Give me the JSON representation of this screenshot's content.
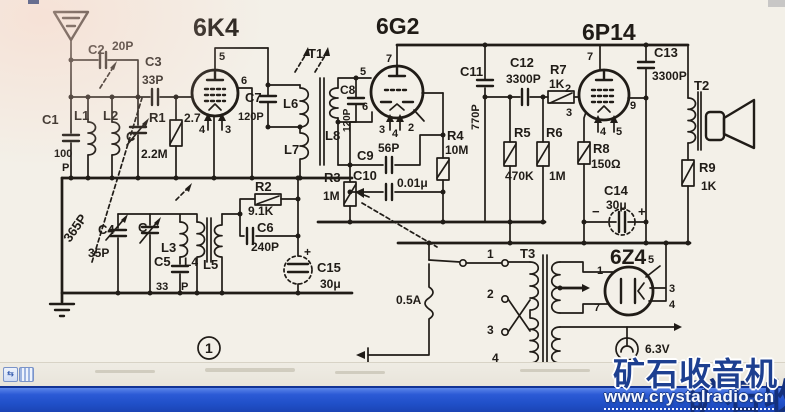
{
  "colors": {
    "paper": "#f3f0e8",
    "ink": "#201c17",
    "taskbar_blue": "#2050c8",
    "watermark_blue": "#1d3f90"
  },
  "watermark": {
    "line1": "矿石收音机",
    "line2": "www.crystalradio.cn"
  },
  "ui": {
    "nav_icon_glyph": "⇆"
  },
  "schematic": {
    "labels": [
      {
        "id": "title-6k4",
        "t": "6K4",
        "x": 193,
        "y": 36,
        "s": 25
      },
      {
        "id": "title-6g2",
        "t": "6G2",
        "x": 376,
        "y": 34,
        "s": 23
      },
      {
        "id": "title-6p14",
        "t": "6P14",
        "x": 582,
        "y": 40,
        "s": 23
      },
      {
        "id": "title-6z4",
        "t": "6Z4",
        "x": 610,
        "y": 264,
        "s": 21
      },
      {
        "id": "c1",
        "t": "C1",
        "x": 42,
        "y": 124,
        "s": 13
      },
      {
        "id": "c1-val",
        "t": "100",
        "x": 54,
        "y": 157,
        "s": 11
      },
      {
        "id": "c1-unit",
        "t": "P",
        "x": 62,
        "y": 171,
        "s": 11
      },
      {
        "id": "c2",
        "t": "C2",
        "x": 88,
        "y": 54,
        "s": 13
      },
      {
        "id": "c2-val",
        "t": "20P",
        "x": 112,
        "y": 50,
        "s": 12
      },
      {
        "id": "c3",
        "t": "C3",
        "x": 145,
        "y": 66,
        "s": 13
      },
      {
        "id": "c3-val",
        "t": "33P",
        "x": 142,
        "y": 84,
        "s": 12
      },
      {
        "id": "c4",
        "t": "C4",
        "x": 98,
        "y": 234,
        "s": 13
      },
      {
        "id": "c4-val",
        "t": "35P",
        "x": 88,
        "y": 257,
        "s": 12
      },
      {
        "id": "c-gang1",
        "t": "C",
        "x": 126,
        "y": 141,
        "s": 13
      },
      {
        "id": "c-gang2",
        "t": "C",
        "x": 138,
        "y": 232,
        "s": 13
      },
      {
        "id": "gang-val",
        "t": "365P",
        "x": 70,
        "y": 243,
        "s": 13,
        "r": -55
      },
      {
        "id": "c5",
        "t": "C5",
        "x": 154,
        "y": 266,
        "s": 13
      },
      {
        "id": "c5-val",
        "t": "33",
        "x": 156,
        "y": 290,
        "s": 11
      },
      {
        "id": "c5-unit",
        "t": "P",
        "x": 181,
        "y": 290,
        "s": 11
      },
      {
        "id": "c6",
        "t": "C6",
        "x": 257,
        "y": 232,
        "s": 13
      },
      {
        "id": "c6-val",
        "t": "240P",
        "x": 251,
        "y": 251,
        "s": 12
      },
      {
        "id": "c7",
        "t": "C7",
        "x": 245,
        "y": 102,
        "s": 13
      },
      {
        "id": "c7-val",
        "t": "120P",
        "x": 238,
        "y": 120,
        "s": 11
      },
      {
        "id": "c8",
        "t": "C8",
        "x": 340,
        "y": 94,
        "s": 12
      },
      {
        "id": "c8-val",
        "t": "120P",
        "x": 350,
        "y": 132,
        "s": 10,
        "r": -90
      },
      {
        "id": "c9",
        "t": "C9",
        "x": 357,
        "y": 160,
        "s": 13
      },
      {
        "id": "c9-val",
        "t": "56P",
        "x": 378,
        "y": 152,
        "s": 12
      },
      {
        "id": "c10",
        "t": "C10",
        "x": 353,
        "y": 180,
        "s": 13
      },
      {
        "id": "c10-val",
        "t": "0.01μ",
        "x": 397,
        "y": 187,
        "s": 12
      },
      {
        "id": "c11",
        "t": "C11",
        "x": 460,
        "y": 76,
        "s": 13
      },
      {
        "id": "c11-val",
        "t": "770P",
        "x": 479,
        "y": 130,
        "s": 11,
        "r": -90
      },
      {
        "id": "c12",
        "t": "C12",
        "x": 510,
        "y": 67,
        "s": 13
      },
      {
        "id": "c12-val",
        "t": "3300P",
        "x": 506,
        "y": 83,
        "s": 12
      },
      {
        "id": "c13",
        "t": "C13",
        "x": 654,
        "y": 57,
        "s": 13
      },
      {
        "id": "c13-val",
        "t": "3300P",
        "x": 652,
        "y": 80,
        "s": 12
      },
      {
        "id": "c14",
        "t": "C14",
        "x": 604,
        "y": 195,
        "s": 13
      },
      {
        "id": "c14-val",
        "t": "30μ",
        "x": 606,
        "y": 209,
        "s": 12
      },
      {
        "id": "c14-plus",
        "t": "+",
        "x": 638,
        "y": 216,
        "s": 13
      },
      {
        "id": "c14-minus",
        "t": "−",
        "x": 592,
        "y": 216,
        "s": 13
      },
      {
        "id": "c15",
        "t": "C15",
        "x": 317,
        "y": 272,
        "s": 13
      },
      {
        "id": "c15-val",
        "t": "30μ",
        "x": 320,
        "y": 288,
        "s": 12
      },
      {
        "id": "c15-plus",
        "t": "+",
        "x": 304,
        "y": 256,
        "s": 12
      },
      {
        "id": "r1",
        "t": "R1",
        "x": 149,
        "y": 122,
        "s": 13
      },
      {
        "id": "r1-val",
        "t": "2.2M",
        "x": 141,
        "y": 158,
        "s": 12
      },
      {
        "id": "r1-aux",
        "t": "2.7",
        "x": 184,
        "y": 122,
        "s": 12
      },
      {
        "id": "r2",
        "t": "R2",
        "x": 255,
        "y": 191,
        "s": 13
      },
      {
        "id": "r2-val",
        "t": "9.1K",
        "x": 248,
        "y": 215,
        "s": 12
      },
      {
        "id": "r3",
        "t": "R3",
        "x": 324,
        "y": 182,
        "s": 13
      },
      {
        "id": "r3-val",
        "t": "1M",
        "x": 323,
        "y": 200,
        "s": 12
      },
      {
        "id": "r4",
        "t": "R4",
        "x": 447,
        "y": 140,
        "s": 13
      },
      {
        "id": "r4-val",
        "t": "10M",
        "x": 445,
        "y": 154,
        "s": 12
      },
      {
        "id": "r5",
        "t": "R5",
        "x": 514,
        "y": 137,
        "s": 13
      },
      {
        "id": "r5-val",
        "t": "470K",
        "x": 505,
        "y": 180,
        "s": 12
      },
      {
        "id": "r6",
        "t": "R6",
        "x": 546,
        "y": 137,
        "s": 13
      },
      {
        "id": "r6-val",
        "t": "1M",
        "x": 549,
        "y": 180,
        "s": 12
      },
      {
        "id": "r7",
        "t": "R7",
        "x": 550,
        "y": 74,
        "s": 13
      },
      {
        "id": "r7-val",
        "t": "1K",
        "x": 549,
        "y": 88,
        "s": 12
      },
      {
        "id": "r8",
        "t": "R8",
        "x": 593,
        "y": 153,
        "s": 13
      },
      {
        "id": "r8-val",
        "t": "150Ω",
        "x": 591,
        "y": 168,
        "s": 12
      },
      {
        "id": "r9",
        "t": "R9",
        "x": 699,
        "y": 172,
        "s": 13
      },
      {
        "id": "r9-val",
        "t": "1K",
        "x": 701,
        "y": 190,
        "s": 12
      },
      {
        "id": "l1",
        "t": "L1",
        "x": 74,
        "y": 120,
        "s": 13
      },
      {
        "id": "l2",
        "t": "L2",
        "x": 103,
        "y": 120,
        "s": 13
      },
      {
        "id": "l3",
        "t": "L3",
        "x": 161,
        "y": 252,
        "s": 13
      },
      {
        "id": "l4",
        "t": "L4",
        "x": 184,
        "y": 266,
        "s": 12
      },
      {
        "id": "l5",
        "t": "L5",
        "x": 203,
        "y": 269,
        "s": 13
      },
      {
        "id": "l6",
        "t": "L6",
        "x": 283,
        "y": 108,
        "s": 13
      },
      {
        "id": "l7",
        "t": "L7",
        "x": 284,
        "y": 154,
        "s": 13
      },
      {
        "id": "l8",
        "t": "L8",
        "x": 325,
        "y": 140,
        "s": 13
      },
      {
        "id": "t1",
        "t": "T1",
        "x": 308,
        "y": 58,
        "s": 13
      },
      {
        "id": "t2",
        "t": "T2",
        "x": 694,
        "y": 90,
        "s": 13
      },
      {
        "id": "t3",
        "t": "T3",
        "x": 520,
        "y": 258,
        "s": 13
      },
      {
        "id": "fuse-val",
        "t": "0.5A",
        "x": 396,
        "y": 304,
        "s": 12
      },
      {
        "id": "pilot-val",
        "t": "6.3V",
        "x": 645,
        "y": 353,
        "s": 12
      },
      {
        "id": "pin-6k4-5",
        "t": "5",
        "x": 219,
        "y": 60,
        "s": 11
      },
      {
        "id": "pin-6k4-6",
        "t": "6",
        "x": 241,
        "y": 84,
        "s": 11
      },
      {
        "id": "pin-6k4-4",
        "t": "4",
        "x": 199,
        "y": 133,
        "s": 11
      },
      {
        "id": "pin-6k4-3",
        "t": "3",
        "x": 225,
        "y": 133,
        "s": 11
      },
      {
        "id": "pin-6g2-7",
        "t": "7",
        "x": 386,
        "y": 62,
        "s": 11
      },
      {
        "id": "pin-6g2-5",
        "t": "5",
        "x": 360,
        "y": 75,
        "s": 11
      },
      {
        "id": "pin-6g2-6",
        "t": "6",
        "x": 362,
        "y": 110,
        "s": 11
      },
      {
        "id": "pin-6g2-3",
        "t": "3",
        "x": 379,
        "y": 133,
        "s": 11
      },
      {
        "id": "pin-6g2-4",
        "t": "4",
        "x": 392,
        "y": 137,
        "s": 11
      },
      {
        "id": "pin-6g2-2",
        "t": "2",
        "x": 408,
        "y": 131,
        "s": 11
      },
      {
        "id": "pin-6p14-7",
        "t": "7",
        "x": 587,
        "y": 60,
        "s": 11
      },
      {
        "id": "pin-6p14-2",
        "t": "2",
        "x": 565,
        "y": 92,
        "s": 11
      },
      {
        "id": "pin-6p14-3",
        "t": "3",
        "x": 566,
        "y": 116,
        "s": 11
      },
      {
        "id": "pin-6p14-9",
        "t": "9",
        "x": 630,
        "y": 109,
        "s": 11
      },
      {
        "id": "pin-6p14-4",
        "t": "4",
        "x": 600,
        "y": 135,
        "s": 11
      },
      {
        "id": "pin-6p14-5",
        "t": "5",
        "x": 616,
        "y": 135,
        "s": 11
      },
      {
        "id": "pin-6z4-1",
        "t": "1",
        "x": 597,
        "y": 274,
        "s": 11
      },
      {
        "id": "pin-6z4-7",
        "t": "7",
        "x": 594,
        "y": 311,
        "s": 11
      },
      {
        "id": "pin-6z4-5",
        "t": "5",
        "x": 648,
        "y": 263,
        "s": 11
      },
      {
        "id": "pin-6z4-3",
        "t": "3",
        "x": 669,
        "y": 292,
        "s": 11
      },
      {
        "id": "pin-6z4-4",
        "t": "4",
        "x": 669,
        "y": 308,
        "s": 11
      },
      {
        "id": "tap-1",
        "t": "1",
        "x": 487,
        "y": 258,
        "s": 12
      },
      {
        "id": "tap-2",
        "t": "2",
        "x": 487,
        "y": 298,
        "s": 12
      },
      {
        "id": "tap-3",
        "t": "3",
        "x": 487,
        "y": 334,
        "s": 12
      },
      {
        "id": "tap-4",
        "t": "4",
        "x": 492,
        "y": 362,
        "s": 12
      },
      {
        "id": "section-1",
        "t": "1",
        "x": 205,
        "y": 353,
        "s": 14
      }
    ]
  }
}
